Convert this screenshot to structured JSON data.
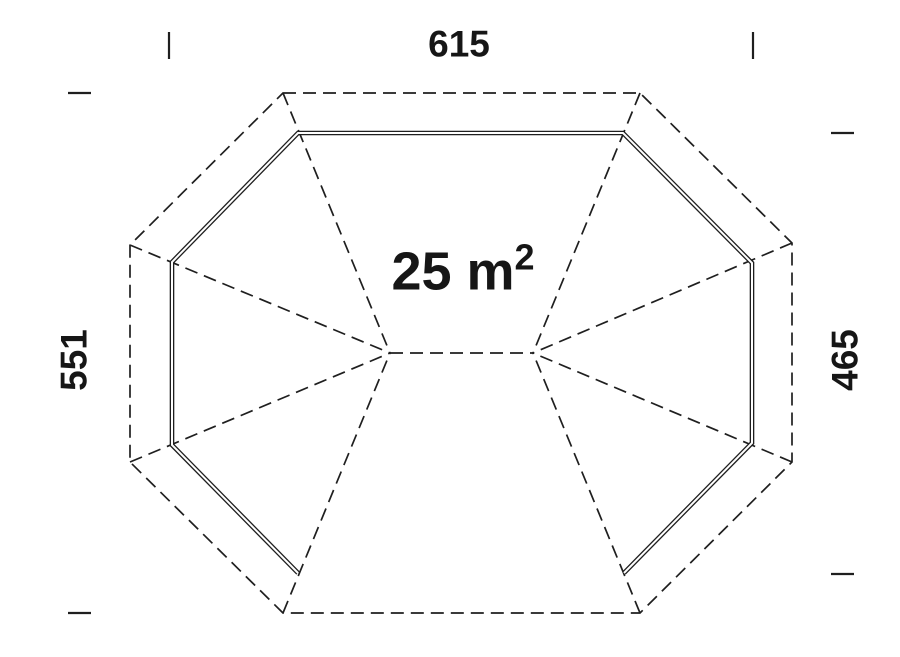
{
  "colors": {
    "background": "#ffffff",
    "line": "#1f1f1f",
    "text": "#161616"
  },
  "labels": {
    "width": "615",
    "height_left": "551",
    "height_right": "465",
    "area_base": "25 m",
    "area_exponent": "2"
  },
  "drawing": {
    "roof_outline": [
      [
        283,
        93
      ],
      [
        640,
        93
      ],
      [
        792,
        243
      ],
      [
        792,
        462
      ],
      [
        640,
        613
      ],
      [
        283,
        613
      ],
      [
        130,
        462
      ],
      [
        130,
        245
      ]
    ],
    "wall_path": [
      [
        298,
        573
      ],
      [
        172,
        445
      ],
      [
        172,
        262
      ],
      [
        298,
        133
      ],
      [
        623,
        133
      ],
      [
        752,
        263
      ],
      [
        752,
        443
      ],
      [
        624,
        573
      ]
    ],
    "ridge": [
      [
        390,
        353
      ],
      [
        533,
        353
      ]
    ],
    "hip_lines": [
      [
        [
          283,
          93
        ],
        [
          390,
          353
        ]
      ],
      [
        [
          130,
          245
        ],
        [
          390,
          353
        ]
      ],
      [
        [
          130,
          462
        ],
        [
          390,
          353
        ]
      ],
      [
        [
          283,
          613
        ],
        [
          390,
          353
        ]
      ],
      [
        [
          640,
          93
        ],
        [
          533,
          353
        ]
      ],
      [
        [
          792,
          243
        ],
        [
          533,
          353
        ]
      ],
      [
        [
          792,
          462
        ],
        [
          533,
          353
        ]
      ],
      [
        [
          640,
          613
        ],
        [
          533,
          353
        ]
      ]
    ],
    "dimension_ticks": [
      [
        [
          169,
          32
        ],
        [
          169,
          59
        ]
      ],
      [
        [
          753,
          32
        ],
        [
          753,
          59
        ]
      ],
      [
        [
          68,
          93
        ],
        [
          91,
          93
        ]
      ],
      [
        [
          68,
          613
        ],
        [
          91,
          613
        ]
      ],
      [
        [
          831,
          133
        ],
        [
          854,
          133
        ]
      ],
      [
        [
          831,
          574
        ],
        [
          854,
          574
        ]
      ]
    ]
  }
}
